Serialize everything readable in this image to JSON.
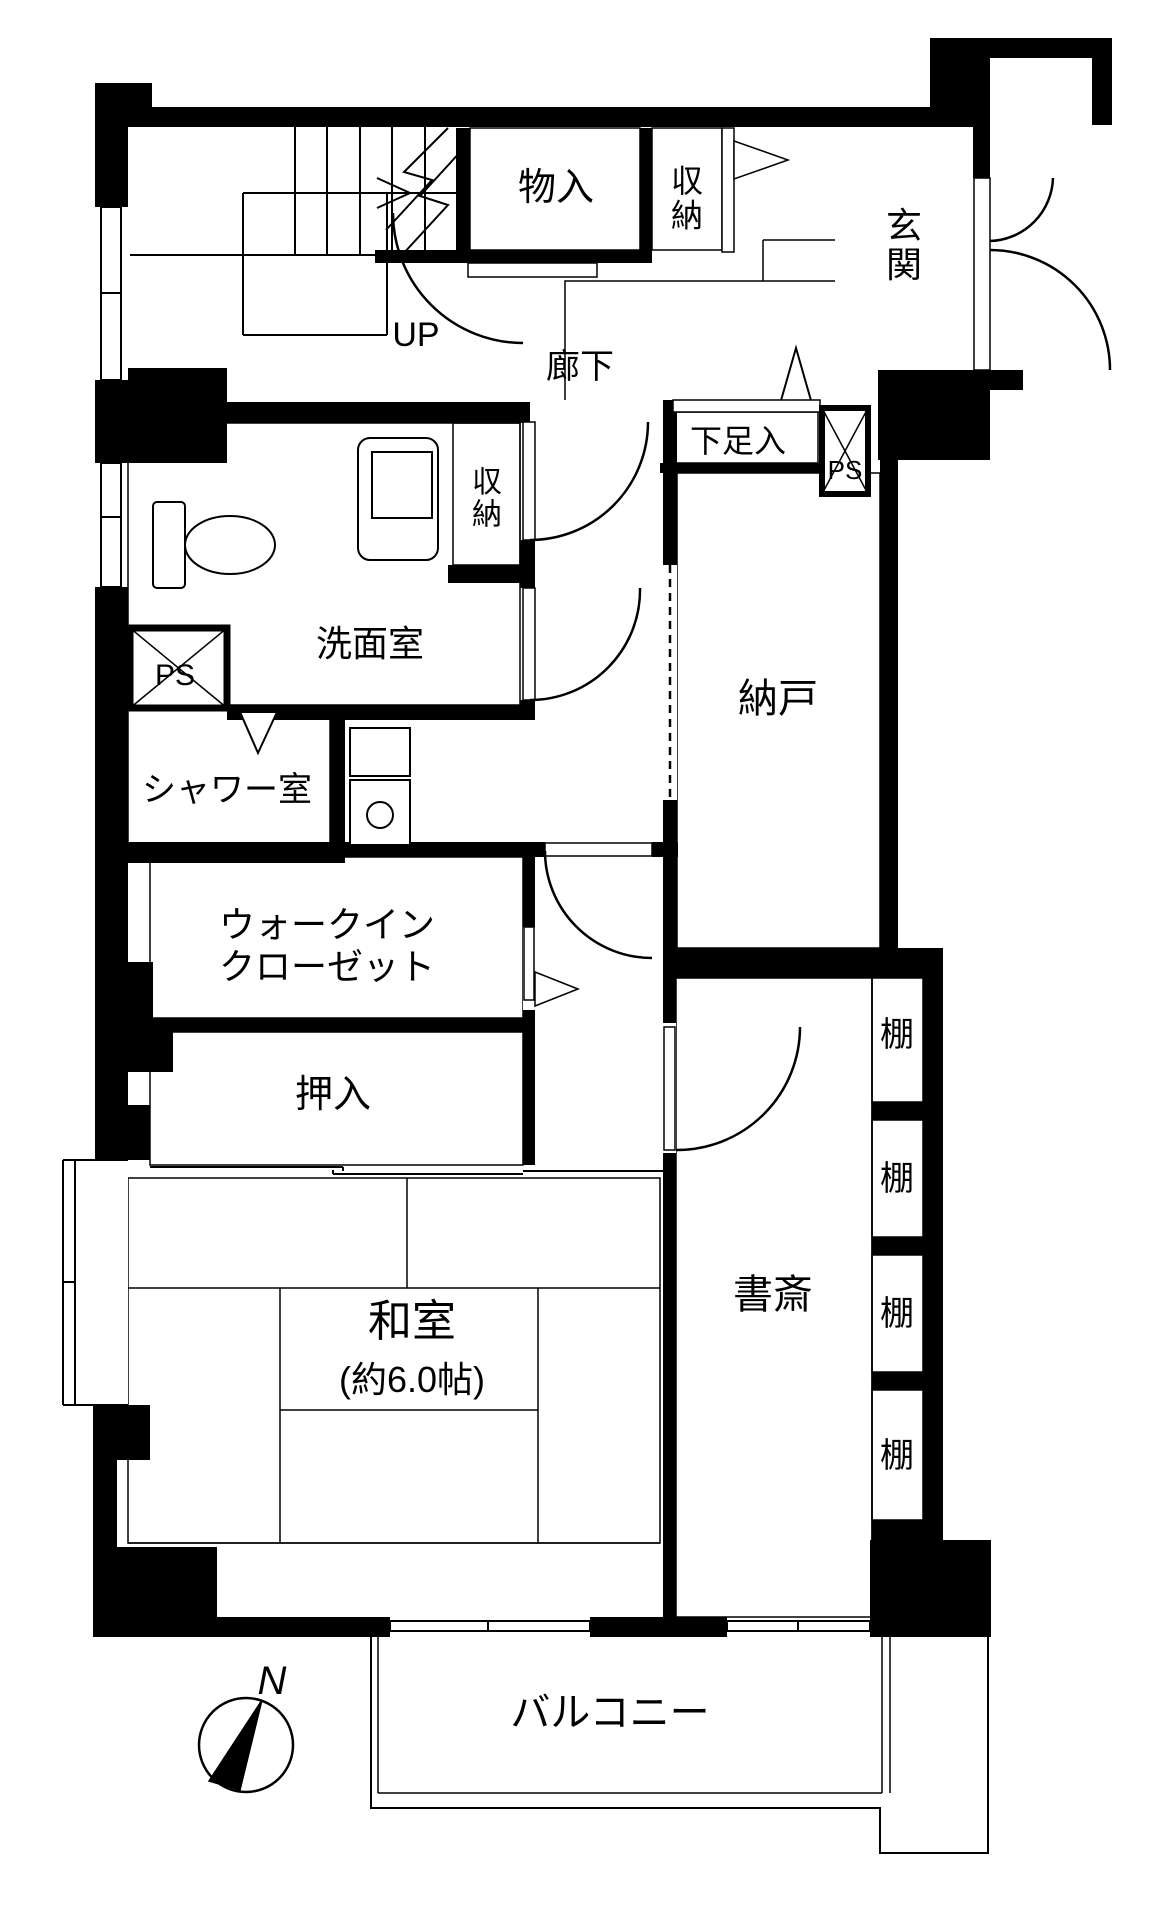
{
  "colors": {
    "wall": "#000000",
    "closet_pink": "#f7e3f3",
    "wet_blue": "#d9f0f1",
    "storage_cream": "#fcf9e1",
    "tatami_green": "#e3f2e2",
    "floor_white": "#ffffff"
  },
  "rooms": {
    "monoire": {
      "label": "物入"
    },
    "shuno_top": {
      "label": "収納"
    },
    "genkan": {
      "label": "玄関"
    },
    "roka": {
      "label": "廊下"
    },
    "shitasokuire": {
      "label": "下足入"
    },
    "nando": {
      "label": "納戸"
    },
    "senmenshitsu": {
      "label": "洗面室"
    },
    "shuno_senmen": {
      "label": "収納"
    },
    "shower": {
      "label": "シャワー室"
    },
    "wic": {
      "label_line1": "ウォークイン",
      "label_line2": "クローゼット"
    },
    "oshiire": {
      "label": "押入"
    },
    "washitsu": {
      "label": "和室",
      "size_note": "(約6.0帖)"
    },
    "shosai": {
      "label": "書斎"
    },
    "balcony": {
      "label": "バルコニー"
    }
  },
  "annotations": {
    "up": "UP",
    "ps_upper": "PS",
    "ps_lower": "PS",
    "north": "N"
  },
  "shelves": [
    "棚",
    "棚",
    "棚",
    "棚"
  ]
}
